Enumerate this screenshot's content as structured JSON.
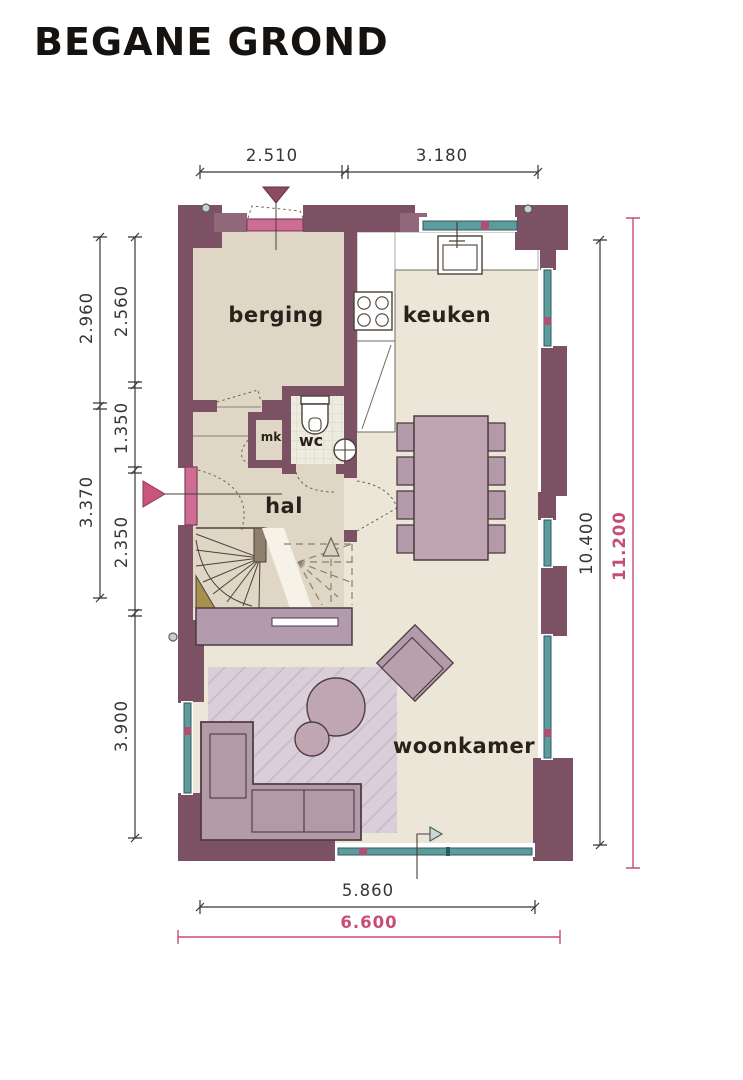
{
  "title": "BEGANE GROND",
  "plan": {
    "rooms": [
      {
        "id": "berging",
        "label": "berging"
      },
      {
        "id": "keuken",
        "label": "keuken"
      },
      {
        "id": "wc",
        "label": "wc"
      },
      {
        "id": "mk",
        "label": "mk"
      },
      {
        "id": "hal",
        "label": "hal"
      },
      {
        "id": "woonkamer",
        "label": "woonkamer"
      }
    ],
    "dimensions": {
      "top": [
        "2.510",
        "3.180"
      ],
      "left_outer": [
        "2.960",
        "3.370"
      ],
      "left_inner": [
        "2.560",
        "1.350",
        "2.350",
        "3.900"
      ],
      "right_inner": "10.400",
      "right_total": "11.200",
      "bottom_inner": "5.860",
      "bottom_total": "6.600"
    },
    "colors": {
      "wall": "#7d5164",
      "window_teal": "#5d9c9c",
      "door_pink": "#cd6d93",
      "dimension_accent_pink": "#c84d74",
      "floor_cream": "#ece6d8",
      "floor_tan": "#e0d6c5",
      "furniture_mauve": "#b29aa8"
    }
  }
}
